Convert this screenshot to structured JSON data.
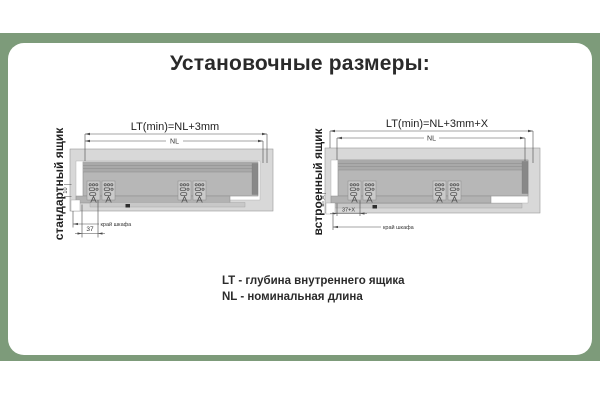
{
  "title": "Установочные размеры:",
  "colors": {
    "background_band": "#7d9b7a",
    "card": "#ffffff",
    "title_text": "#2a2a2a",
    "drawing_body_gray": "#b7b7b7",
    "drawing_frame_gray": "#d8d8d8"
  },
  "diagrams": {
    "standard": {
      "side_label": "стандартный ящик",
      "lt_formula": "LT(min)=NL+3mm",
      "nl_label": "NL",
      "height_dim": "10",
      "offset_dim": "37",
      "cabinet_edge": "край шкафа"
    },
    "builtin": {
      "side_label": "встроенный ящик",
      "lt_formula": "LT(min)=NL+3mm+X",
      "nl_label": "NL",
      "recess_dim": "X",
      "offset_dim": "37+X",
      "cabinet_edge": "край шкафа"
    }
  },
  "legend": {
    "lines": [
      "LT - глубина внутреннего ящика",
      "NL - номинальная длина"
    ]
  }
}
